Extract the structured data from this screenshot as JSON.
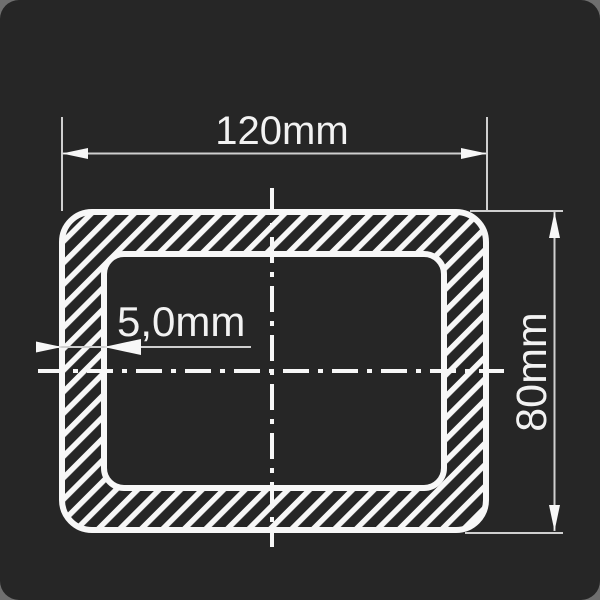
{
  "colors": {
    "outer_bg": "#6f6f6f",
    "panel_bg": "#262626",
    "line": "#f7f7f7",
    "dim_line": "#cfcfcf",
    "text_color": "#f2f2f2"
  },
  "dimensions": {
    "width": {
      "label": "120mm",
      "value": 120,
      "unit": "mm"
    },
    "height": {
      "label": "80mm",
      "value": 80,
      "unit": "mm"
    },
    "wall_thickness": {
      "label": "5,0mm",
      "value": 5.0,
      "unit": "mm"
    }
  }
}
